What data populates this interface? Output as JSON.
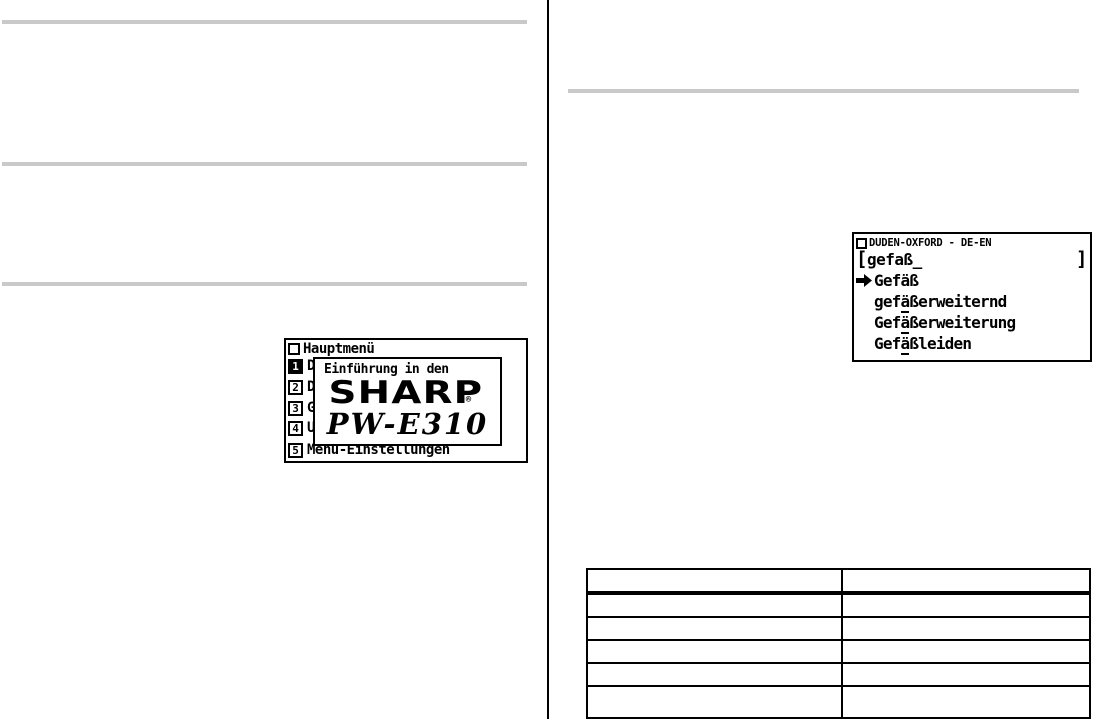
{
  "colors": {
    "ink": "#000000",
    "section_rule": "#c9c9c9",
    "screen_bg": "#ffffff"
  },
  "icons": {
    "title_square": "window-title-square (small outlined box before LCD screen titles)",
    "pointer_arrow": "solid right-pointing selection arrow"
  },
  "screen1": {
    "header_title": "Hauptmenü",
    "menu_items": [
      {
        "number": "1",
        "label": "D",
        "selected": true
      },
      {
        "number": "2",
        "label": "D",
        "selected": false
      },
      {
        "number": "3",
        "label": "G",
        "selected": false
      },
      {
        "number": "4",
        "label": "U",
        "selected": false
      },
      {
        "number": "5",
        "label": "Menü-Einstellungen",
        "selected": false
      }
    ],
    "popup": {
      "intro": "Einführung in den",
      "brand": "SHARP",
      "registered": "®",
      "model": "PW-E310"
    }
  },
  "screen2": {
    "header_title": "DUDEN-OXFORD - DE-EN",
    "input": {
      "open": "[",
      "value": "gefaß",
      "cursor": "_",
      "close": "]"
    },
    "results": [
      {
        "prefix": "Gefäß",
        "underline": "",
        "suffix": "",
        "selected": true
      },
      {
        "prefix": "gef",
        "underline": "ä",
        "suffix": "ßerweiternd",
        "selected": false
      },
      {
        "prefix": "Gef",
        "underline": "ä",
        "suffix": "ßerweiterung",
        "selected": false
      },
      {
        "prefix": "Gef",
        "underline": "ä",
        "suffix": "ßleiden",
        "selected": false
      }
    ]
  },
  "table": {
    "columns": [
      "",
      ""
    ],
    "rows": [
      [
        "",
        ""
      ],
      [
        "",
        ""
      ],
      [
        "",
        ""
      ],
      [
        "",
        ""
      ],
      [
        "",
        ""
      ]
    ]
  }
}
